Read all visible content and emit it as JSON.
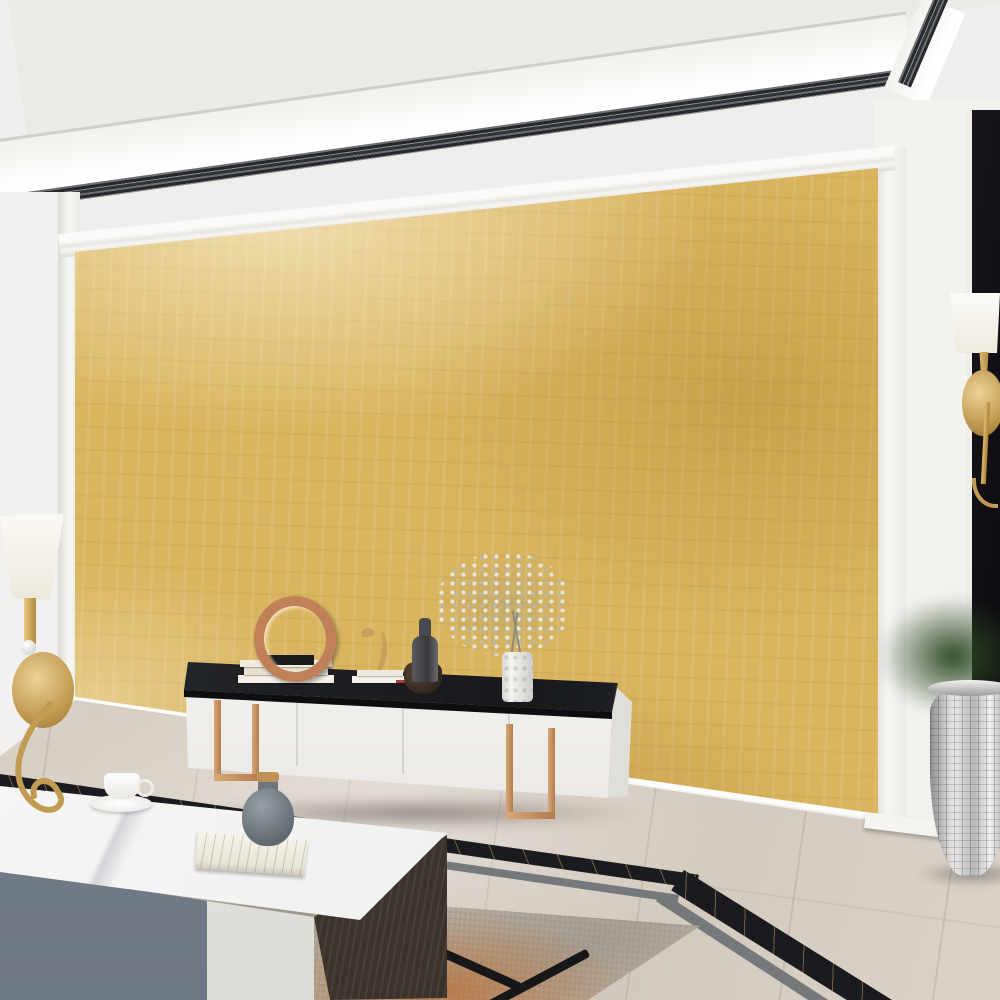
{
  "scene": {
    "kind": "interior-photo",
    "room": "modern living room",
    "feature": "3d-hexagon-mural-wall"
  },
  "palette": {
    "accent_gold": "#cda254",
    "wall_gold": "#d9b55f",
    "black_marble": "#161419",
    "rose_gold": "#c08a5e",
    "floor_beige": "#d8cfc3"
  },
  "ceiling": {
    "base": "#efeeec",
    "upper": "#ebeae7",
    "cove": "#ffffff",
    "trim_dark": "#26282b",
    "trim_light": "#8a8d91",
    "spotlights": [
      [
        360,
        186
      ],
      [
        552,
        150
      ],
      [
        795,
        102
      ],
      [
        958,
        96
      ]
    ]
  },
  "chandelier": {
    "gold": "#caa35c",
    "gold_light": "#f0dfae",
    "shade_color": "#fbfaf6",
    "crystal": "#f2f3f5",
    "shade_count": 8,
    "shades": [
      [
        47,
        63,
        64,
        50,
        14
      ],
      [
        152,
        38,
        84,
        64,
        2
      ],
      [
        253,
        56,
        72,
        74,
        -14
      ],
      [
        308,
        93,
        56,
        70,
        -24
      ],
      [
        202,
        145,
        62,
        80,
        -12
      ],
      [
        275,
        152,
        66,
        70,
        -22
      ],
      [
        20,
        158,
        50,
        40,
        12
      ],
      [
        32,
        219,
        56,
        48,
        8
      ]
    ],
    "arms": [
      "M150,150 C125,190 62,186 44,94",
      "M150,120 C150,104 152,90 152,78",
      "M150,150 C186,186 236,176 250,100",
      "M150,154 C202,196 282,186 306,132",
      "M150,158 C164,196 186,200 200,188",
      "M150,158 C192,216 252,214 272,190",
      "M150,156 C102,206 42,206 20,182",
      "M150,162 C112,226 62,247 34,244",
      "M150,162 C140,200 120,214 96,212",
      "M150,160 C170,204 206,216 232,210"
    ],
    "crystals": [
      [
        44,
        102
      ],
      [
        152,
        84
      ],
      [
        249,
        106
      ],
      [
        304,
        138
      ],
      [
        200,
        194
      ],
      [
        271,
        196
      ],
      [
        21,
        188
      ],
      [
        34,
        248
      ],
      [
        150,
        170
      ],
      [
        140,
        180
      ],
      [
        161,
        177
      ],
      [
        96,
        212
      ],
      [
        232,
        210
      ]
    ]
  },
  "left_wall": {
    "base": "#f2f1ef",
    "stripe_color": "#1d1e23",
    "stripes": [
      [
        0,
        9
      ],
      [
        22,
        20
      ],
      [
        50,
        8
      ]
    ],
    "pilaster": "#f8f7f5"
  },
  "right_wall": {
    "white": "#f3f2ef",
    "black": "#141217",
    "fretwork": [
      [
        947,
        112,
        20,
        252
      ],
      [
        918,
        362,
        82,
        20
      ],
      [
        916,
        380,
        21,
        98
      ],
      [
        934,
        460,
        32,
        19
      ],
      [
        947,
        478,
        20,
        86
      ]
    ]
  },
  "sconces": {
    "shade": "#fcfaf5",
    "gold": "#c29b52",
    "count": 2
  },
  "mural": {
    "frame": "#f6f5f2",
    "bg": "#d9b55f",
    "hex_w": 100,
    "hex_h": 116,
    "colors": {
      "cream": "#f2e7c9",
      "ivory": "#f5efdc",
      "white": "#f4f3f0",
      "silver": "#dfe0e5",
      "bgray": "#9ba1ad",
      "bgrayl": "#b7bcc6",
      "tan": "#e3b377",
      "gold": "#d8ad62",
      "orange": "#d2914a",
      "orange2": "#c67f36",
      "peach": "#eecda2",
      "sand": "#e7d49e",
      "khaki": "#ddc488",
      "lav": "#d2bbc7",
      "mauve": "#a17f97"
    },
    "tiles": [
      [
        370,
        288,
        "cream",
        "pyr"
      ],
      [
        573,
        330,
        "ivory",
        "flat"
      ],
      [
        220,
        346,
        "white",
        "pyr"
      ],
      [
        320,
        346,
        "bgray",
        "flat"
      ],
      [
        420,
        344,
        "white",
        "pyr"
      ],
      [
        70,
        432,
        "peach",
        "pyr"
      ],
      [
        170,
        430,
        "orange",
        "pyr"
      ],
      [
        270,
        428,
        "tan",
        "pyr"
      ],
      [
        370,
        426,
        "silver",
        "pyr"
      ],
      [
        470,
        424,
        "gold",
        "pyr"
      ],
      [
        570,
        424,
        "bgrayl",
        "flat"
      ],
      [
        670,
        420,
        "sand",
        "pyr"
      ],
      [
        770,
        416,
        "tan",
        "pyr"
      ],
      [
        120,
        516,
        "lav",
        "pyr"
      ],
      [
        220,
        514,
        "bgray",
        "flat"
      ],
      [
        320,
        512,
        "sand",
        "pyr"
      ],
      [
        420,
        510,
        "cream",
        "pyr"
      ],
      [
        520,
        508,
        "silver",
        "pyr"
      ],
      [
        620,
        506,
        "mauve",
        "flat"
      ],
      [
        720,
        502,
        "orange",
        "pyr"
      ],
      [
        795,
        485,
        "tan",
        "pyr"
      ],
      [
        170,
        600,
        "sand",
        "flat"
      ],
      [
        270,
        598,
        "gold",
        "pyr"
      ],
      [
        370,
        596,
        "orange2",
        "pyr"
      ],
      [
        470,
        594,
        "khaki",
        "flat"
      ],
      [
        570,
        592,
        "white",
        "pyr"
      ],
      [
        670,
        590,
        "sand",
        "flat"
      ],
      [
        220,
        686,
        "cream",
        "flat"
      ],
      [
        320,
        684,
        "tan",
        "pyr"
      ],
      [
        420,
        682,
        "lav",
        "pyr"
      ],
      [
        520,
        680,
        "sand",
        "flat"
      ]
    ],
    "watermarks": [
      [
        300,
        640,
        190,
        0.2,
        "#fdf6e0"
      ],
      [
        120,
        330,
        150,
        0.18,
        "#fbf2da"
      ],
      [
        690,
        235,
        160,
        0.16,
        "#fdf6e0"
      ],
      [
        900,
        430,
        170,
        0.2,
        "#fdf6e0"
      ],
      [
        930,
        700,
        170,
        0.18,
        "#fbf2da"
      ],
      [
        790,
        620,
        150,
        0.14,
        "#fdf6e0"
      ],
      [
        540,
        250,
        130,
        0.1,
        "#8a6a20"
      ],
      [
        850,
        320,
        120,
        0.08,
        "#8a6a20"
      ],
      [
        200,
        745,
        160,
        0.16,
        "#fdf6e0"
      ]
    ],
    "glows": [
      [
        355,
        262
      ],
      [
        548,
        228
      ],
      [
        788,
        190
      ]
    ]
  },
  "console": {
    "body": "#f6f5f3",
    "top": "#1d2024",
    "legs": "#c08a5e",
    "seams_x": [
      296,
      402,
      508
    ]
  },
  "console_decor": {
    "books": "#f1ecdf",
    "ring": "#c08058",
    "plinth": "#1b1b1d",
    "seahorse": "#c9a05c",
    "bottle": "#4a4a4e",
    "bowl": "#3a2e26",
    "white_vase": "#f5f4f0",
    "flowers": "#e8e8e2",
    "bookmark_red": "#b33a2e"
  },
  "coffee_table": {
    "top": "#fafaf9",
    "front_gray": "#7b8490",
    "front_white": "#e9e7e2",
    "wood": "#3b322b",
    "legs": "#17171a",
    "cup": "#ffffff",
    "vase": "#76808a",
    "cork": "#bd9258",
    "book": "#f1ede3"
  },
  "floor": {
    "base": "#d8cfc3",
    "stripe_black": "#191b1f",
    "stripe_gray": "#75797c",
    "vein_gold": "#b98a4a"
  },
  "rug": {
    "base": "#b2a698",
    "orange": "#c2743a",
    "gray": "#8d8d87",
    "light": "#cfc8bb"
  },
  "plant": {
    "leaf_dark": "#2e5227",
    "leaf_light": "#4e7c3a",
    "cactus": "#6f9a50",
    "pampas": "#ece4d2",
    "orchid": "#5b9bd3",
    "orchid_light": "#8cbde8",
    "vase_silver": "#c9c9c9",
    "flowers": [
      [
        868,
        584
      ],
      [
        888,
        596
      ],
      [
        908,
        588
      ],
      [
        926,
        606
      ],
      [
        878,
        616
      ],
      [
        898,
        628
      ],
      [
        862,
        636
      ],
      [
        914,
        646
      ],
      [
        934,
        634
      ],
      [
        886,
        656
      ],
      [
        904,
        668
      ],
      [
        870,
        674
      ],
      [
        918,
        684
      ],
      [
        938,
        660
      ]
    ],
    "leaf_count": 12,
    "pampas_pos": [
      [
        922,
        556
      ],
      [
        948,
        570
      ],
      [
        976,
        590
      ],
      [
        994,
        618
      ]
    ],
    "cacti": [
      [
        956,
        668,
        34
      ],
      [
        990,
        650,
        30
      ]
    ]
  }
}
